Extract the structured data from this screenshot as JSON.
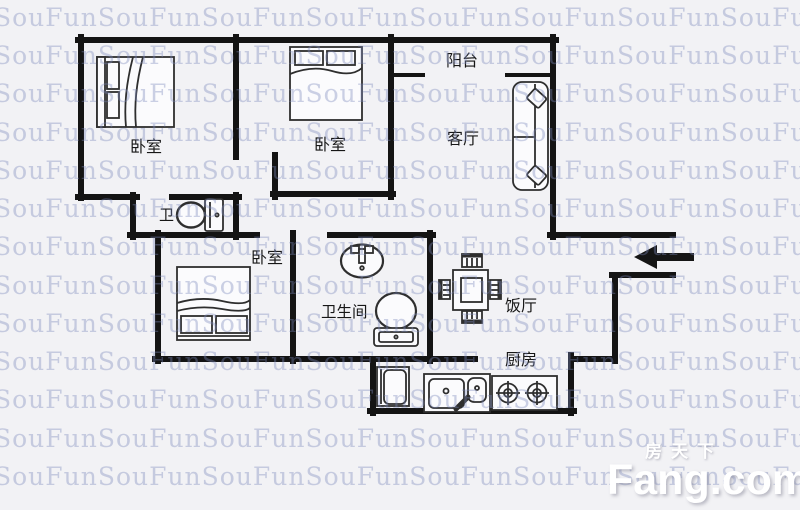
{
  "watermark": {
    "text": "SouFunSouFunSouFunSouFunSouFunSouFunSouFunSouFunSouFunSouFunSouFunSouFun",
    "color": "#7c88ba"
  },
  "room_labels": {
    "bedroom_top_left": "卧室",
    "bedroom_top_middle": "卧室",
    "bedroom_lower": "卧室",
    "balcony": "阳台",
    "living_room": "客厅",
    "toilet": "卫",
    "bathroom": "卫生间",
    "dining_room": "饭厅",
    "kitchen": "厨房"
  },
  "logo": {
    "brand_cn": "房天下",
    "brand_en": "Fang.com"
  },
  "colors": {
    "background": "#f2f2f5",
    "wall": "#141414",
    "furniture_stroke": "#2e2e2e",
    "logo_text": "#ffffff"
  }
}
